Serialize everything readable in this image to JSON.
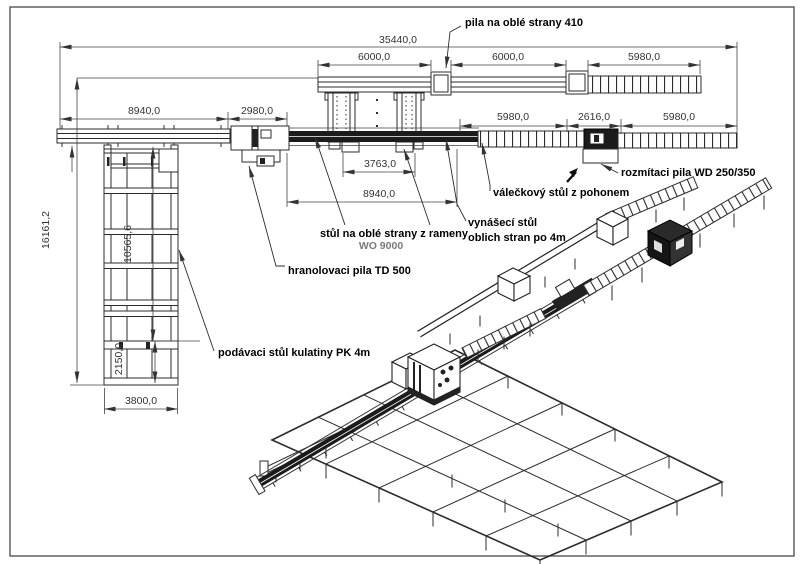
{
  "dimensions": {
    "total_width": "35440,0",
    "top": [
      "6000,0",
      "6000,0",
      "5980,0"
    ],
    "left_main": [
      "8940,0",
      "2980,0"
    ],
    "right_main": [
      "5980,0",
      "2616,0",
      "5980,0"
    ],
    "cross_width": "3763,0",
    "cross_total": "8940,0",
    "height_total": "16161,2",
    "height_upper": "10565,6",
    "height_lower": "2150,0",
    "feed_width": "3800,0"
  },
  "labels": {
    "saw_round_sides": "pila na oblé strany  410",
    "rip_saw": "rozmítaci pila WD 250/350",
    "roller_table": "válečkový stůl z pohonem",
    "outfeed_line1": "vynášecí stůl",
    "outfeed_line2": "oblich stran po 4m",
    "round_sides_table": "stůl na oblé strany z rameny",
    "round_sides_table_model": "WO 9000",
    "squaring_saw": "hranolovaci pila  TD 500",
    "log_infeed": "podávaci stůl kulatiny  PK 4m"
  },
  "colors": {
    "line": "#2b2b2b",
    "dim_text": "#333333",
    "label_text": "#000000",
    "model_gray": "#7a7a7a",
    "machine_dark": "#1b1b1b",
    "background": "#ffffff"
  }
}
